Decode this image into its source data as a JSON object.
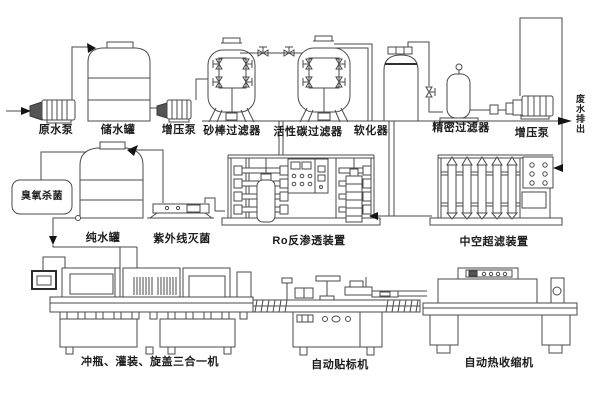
{
  "colors": {
    "background": "#ffffff",
    "line": "#4a4a4a",
    "arrow": "#141414",
    "text": "#1c1c1c"
  },
  "flow": {
    "top_row": {
      "raw_water_pump": "原水泵",
      "storage_tank": "储水罐",
      "booster_pump_1": "增压泵",
      "sand_rod_filter": "砂棒过滤器",
      "activated_carbon_filter": "活性碳过滤器",
      "softener": "软化器",
      "precision_filter": "精密过滤器",
      "booster_pump_2": "增压泵",
      "waste_water_out": "废水排出"
    },
    "mid_row": {
      "ozone_sterilization": "臭氧杀菌",
      "pure_water_tank": "纯水罐",
      "uv_sterilization": "紫外线灭菌",
      "ro_unit": "Ro反渗透装置",
      "uf_unit": "中空超滤装置"
    },
    "bottom_row": {
      "three_in_one_machine": "冲瓶、灌装、旋盖三合一机",
      "labeling_machine": "自动贴标机",
      "heat_shrink_machine": "自动热收缩机"
    }
  }
}
